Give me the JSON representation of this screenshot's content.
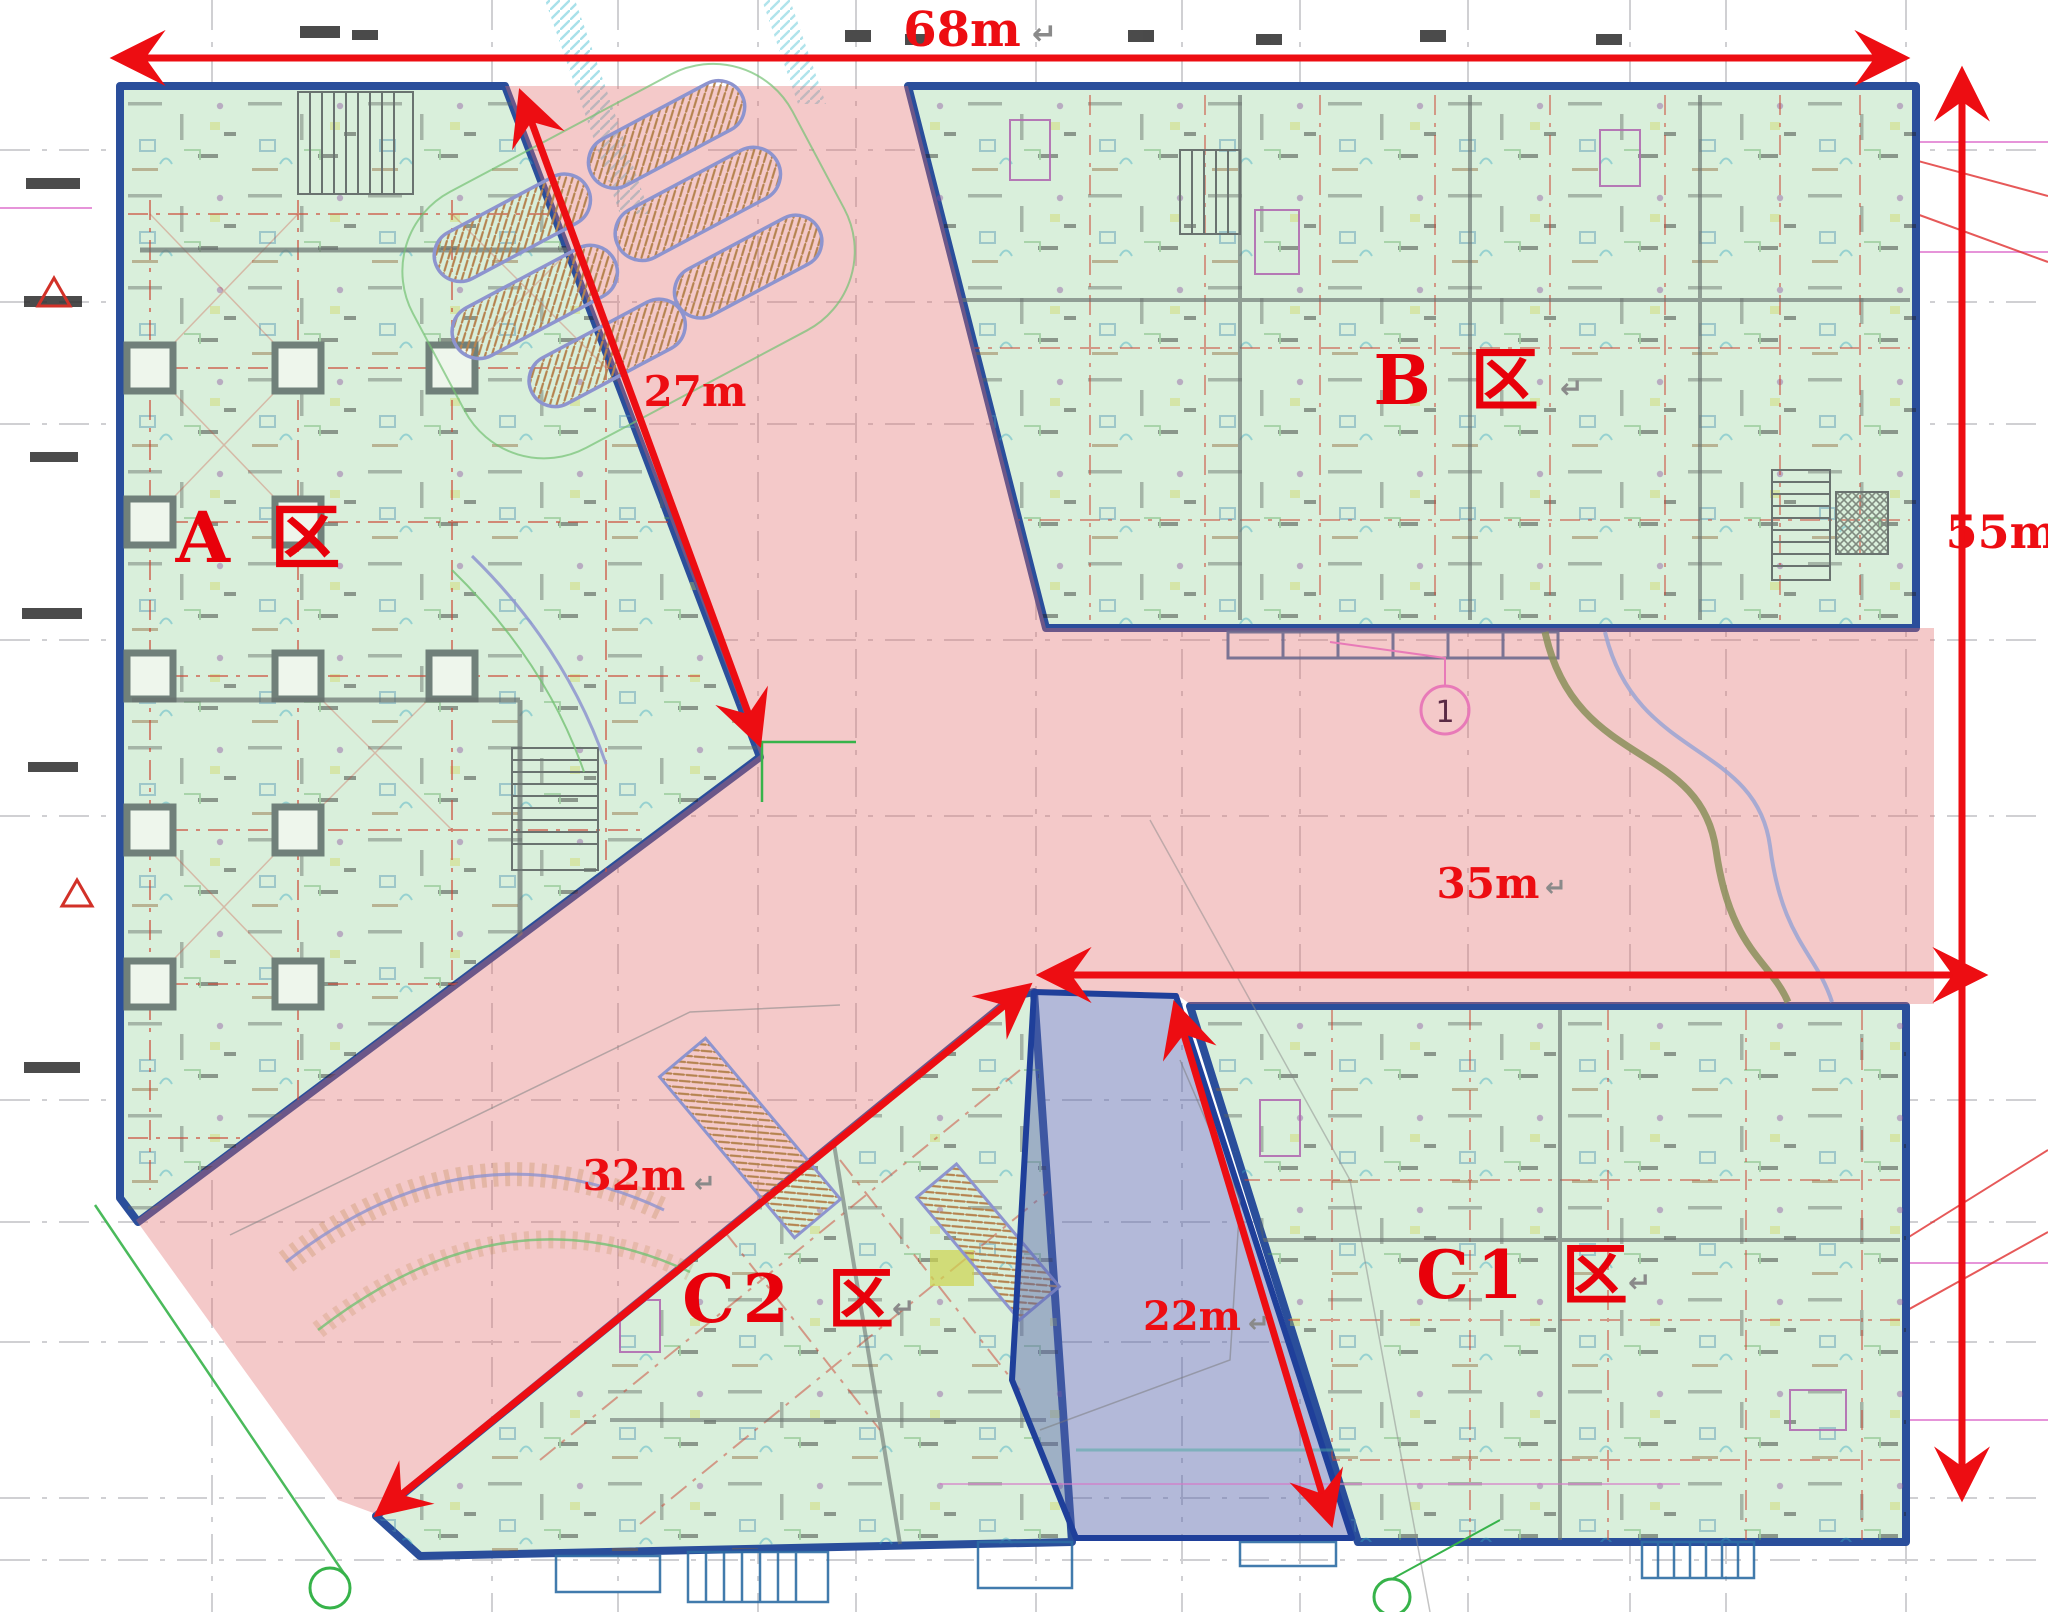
{
  "labels": {
    "zone_a": "A 区",
    "zone_b": "B 区",
    "zone_c1": "C1 区",
    "zone_c2": "C2 区"
  },
  "dimensions": {
    "top_width": "68m",
    "right_height": "55m",
    "north_passage": "27m",
    "middle_passage": "35m",
    "southwest_passage": "32m",
    "c1_passage": "22m"
  },
  "marks": {
    "return_mark": "↵",
    "grid_badge": "1"
  },
  "colors": {
    "dimension_red": "#ed0d12",
    "building_fill": "#d9efdb",
    "building_outline": "#2a4e9b",
    "passage_pink": "#efc7c7",
    "highlight_blue": "#96a2cf"
  }
}
